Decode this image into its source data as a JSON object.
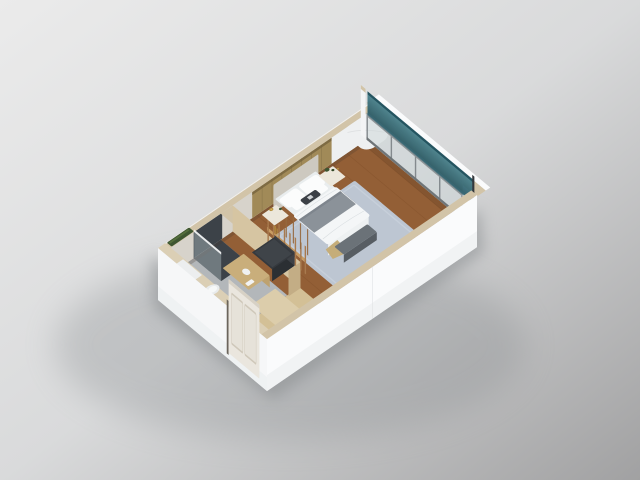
{
  "meta": {
    "description": "3D isometric cutaway rendering of a studio hotel guestroom floor plan",
    "view": "axonometric bird's-eye view, no visible text"
  },
  "colors": {
    "bg_top": "#ebebeb",
    "bg_mid": "#d9dadb",
    "bg_bottom": "#a1a1a2",
    "shadow": "#84888b",
    "ext_wall": "#fafbfc",
    "ext_wall_shade": "#edeff1",
    "wall_top": "#d2c4a8",
    "wall_top_light": "#dbcfb5",
    "inner_wall": "#d7d3cb",
    "wood_floor": "#935f36",
    "plank_line": "#7a4a24",
    "corridor_floor": "#d3c096",
    "bath_floor": "#b3b7ba",
    "shower_dark": "#3c4248",
    "rug": "#bdc6d2",
    "rug_border": "#cdd5e0",
    "duvet": "#f4f6f7",
    "sheet": "#e9edee",
    "blanket": "#8b9299",
    "pillow_white": "#fbfcfc",
    "pillow_dark": "#3b4046",
    "headboard": "#cdc9c0",
    "panel_wood": "#a18a58",
    "nightstand": "#ece7db",
    "cabinet": "#dccdab",
    "slat_wood": "#a87a4e",
    "slat_shelf": "#c89c63",
    "dark_dresser": "#35393e",
    "ottoman": "#6b7278",
    "throw_gold": "#c5ad79",
    "toilet": "#e8ebec",
    "vanity": "#c9ae7b",
    "glass_teal": "#47828f",
    "glass_teal_dark": "#245460",
    "glass_pane": "#ccd6d8",
    "mullion": "#848a8e",
    "curtain": "#eef0f1",
    "door": "#eae6de",
    "plant_green": "#3e5631",
    "lamp_gold": "#b5913f"
  },
  "scene": {
    "rooms": [
      {
        "name": "bedroom",
        "floor": "wood"
      },
      {
        "name": "bathroom",
        "floor": "stone-tile"
      },
      {
        "name": "entry-corridor",
        "floor": "light-wood"
      }
    ],
    "objects": [
      "double-bed",
      "pillows",
      "gray-throw-blanket",
      "foot-ottoman",
      "nightstand-left",
      "nightstand-right",
      "table-lamp",
      "potted-plants",
      "open-slat-wardrobe",
      "dark-dresser",
      "corridor-wardrobe",
      "vanity-counter",
      "toilet",
      "walk-in-shower",
      "shower-glass-screen",
      "wall-planter",
      "window-wall",
      "glass-balustrade",
      "sheer-curtain",
      "entry-door",
      "corner-pillar"
    ]
  }
}
